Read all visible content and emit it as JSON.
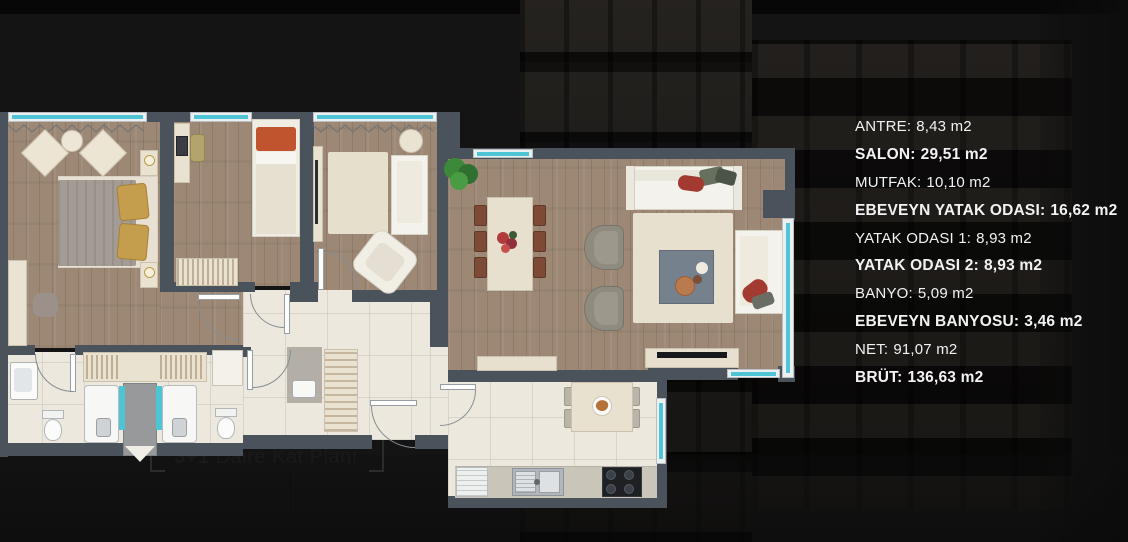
{
  "area_list": {
    "items": [
      {
        "label": "ANTRE:",
        "value": "8,43 m2",
        "bold": false
      },
      {
        "label": "SALON:",
        "value": "29,51 m2",
        "bold": true
      },
      {
        "label": "MUTFAK:",
        "value": "10,10 m2",
        "bold": false
      },
      {
        "label": "EBEVEYN YATAK ODASI:",
        "value": "16,62 m2",
        "bold": true
      },
      {
        "label": "YATAK ODASI 1:",
        "value": "8,93 m2",
        "bold": false
      },
      {
        "label": "YATAK ODASI 2:",
        "value": "8,93 m2",
        "bold": true
      },
      {
        "label": "BANYO:",
        "value": "5,09 m2",
        "bold": false
      },
      {
        "label": "EBEVEYN BANYOSU:",
        "value": "3,46 m2",
        "bold": true
      },
      {
        "label": "NET:",
        "value": "91,07 m2",
        "bold": false
      },
      {
        "label": "BRÜT:",
        "value": "136,63 m2",
        "bold": true
      }
    ]
  },
  "caption": {
    "prefix": "3+1",
    "title": "Daire Kat Planı"
  },
  "colors": {
    "accent_teal": "#4ec5d4",
    "wall_gray": "#4a525b",
    "wood_floor": "#9c8875",
    "tile_floor": "#ece8de",
    "text_white": "#f2f2f2",
    "caption_dark": "#1a1a1a",
    "background_black": "#141313"
  }
}
